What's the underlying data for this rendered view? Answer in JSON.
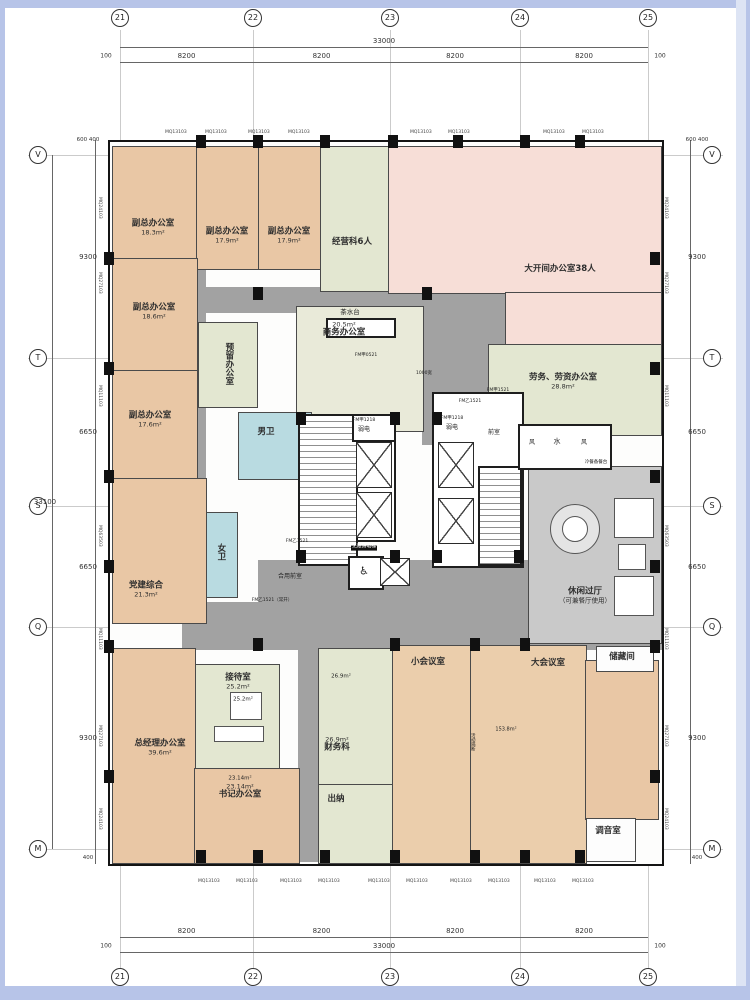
{
  "drawing_type": "office floor plan",
  "colors": {
    "office_tan": "#e9c7a5",
    "open_office_pink": "#f7ded7",
    "green_room": "#e3e7d1",
    "meeting_tan": "#ebceac",
    "toilet_blue": "#b9dbe1",
    "corridor_gray": "#a2a2a2",
    "hall_gray": "#c9c9c9",
    "wall": "#141414",
    "frame_blue": "#b7c4e8",
    "frame_blue_light": "#dde4f4"
  },
  "grid": {
    "cols": [
      {
        "label": "21",
        "x": 120
      },
      {
        "label": "22",
        "x": 253
      },
      {
        "label": "23",
        "x": 390
      },
      {
        "label": "24",
        "x": 520
      },
      {
        "label": "25",
        "x": 648
      }
    ],
    "rows": [
      {
        "label": "V",
        "y": 155
      },
      {
        "label": "T",
        "y": 358
      },
      {
        "label": "S",
        "y": 506
      },
      {
        "label": "Q",
        "y": 627
      },
      {
        "label": "M",
        "y": 849
      }
    ]
  },
  "dims": {
    "top": {
      "total": "33000",
      "segments": [
        "8200",
        "8200",
        "8200",
        "8200"
      ],
      "edge": "100"
    },
    "bottom": {
      "total": "33000",
      "segments": [
        "8200",
        "8200",
        "8200",
        "8200"
      ],
      "edge": "100"
    },
    "left": {
      "total": "33100",
      "segments": [
        "9300",
        "6650",
        "6650",
        "9300"
      ],
      "top_extra": [
        "600",
        "400"
      ],
      "bottom_extra": "400"
    },
    "right": {
      "segments": [
        "9300",
        "6650",
        "6650",
        "9300"
      ],
      "top_extra": [
        "600",
        "400"
      ],
      "bottom_extra": "400"
    }
  },
  "corridors": [
    [
      182,
      255,
      24,
      350
    ],
    [
      182,
      287,
      343,
      26
    ],
    [
      422,
      300,
      108,
      145
    ],
    [
      258,
      560,
      272,
      48
    ],
    [
      182,
      602,
      480,
      48
    ],
    [
      298,
      602,
      20,
      260
    ]
  ],
  "rooms": [
    {
      "label": "副总办公室",
      "area": "18.3m²",
      "x": 112,
      "y": 146,
      "w": 84,
      "h": 112,
      "fill": "#e9c7a5",
      "lx": 153,
      "ly": 228
    },
    {
      "label": "副总办公室",
      "area": "17.9m²",
      "x": 196,
      "y": 146,
      "w": 62,
      "h": 122,
      "fill": "#e9c7a5",
      "lx": 227,
      "ly": 236
    },
    {
      "label": "副总办公室",
      "area": "17.9m²",
      "x": 258,
      "y": 146,
      "w": 62,
      "h": 122,
      "fill": "#e9c7a5",
      "lx": 289,
      "ly": 236
    },
    {
      "label": "经营科6人",
      "x": 320,
      "y": 146,
      "w": 68,
      "h": 144,
      "fill": "#e3e7d1",
      "lx": 352,
      "ly": 243,
      "pat": "pat-desks"
    },
    {
      "label": "大开间办公室38人",
      "x": 388,
      "y": 146,
      "w": 272,
      "h": 146,
      "fill": "#f7ded7",
      "lx": 560,
      "ly": 270,
      "pat": "pat-desks"
    },
    {
      "x": 505,
      "y": 292,
      "w": 155,
      "h": 52,
      "fill": "#f7ded7",
      "pat": "pat-desks"
    },
    {
      "label": "副总办公室",
      "area": "18.6m²",
      "x": 112,
      "y": 258,
      "w": 84,
      "h": 112,
      "fill": "#e9c7a5",
      "lx": 154,
      "ly": 312
    },
    {
      "label": "副总办公室",
      "area": "17.6m²",
      "x": 112,
      "y": 370,
      "w": 84,
      "h": 108,
      "fill": "#e9c7a5",
      "lx": 150,
      "ly": 420
    },
    {
      "label": "预留办公室",
      "x": 198,
      "y": 322,
      "w": 58,
      "h": 84,
      "fill": "#e3e7d1",
      "lx": 228,
      "ly": 364,
      "vert": true,
      "pat": "pat-desks"
    },
    {
      "label": "商务办公室",
      "area": "20.5m²",
      "x": 296,
      "y": 306,
      "w": 126,
      "h": 124,
      "fill": "#e9ead9",
      "lx": 344,
      "ly": 330,
      "areaFirst": true,
      "pat": "pat-desks"
    },
    {
      "label": "劳务、劳资办公室",
      "area": "28.8m²",
      "x": 488,
      "y": 344,
      "w": 172,
      "h": 90,
      "fill": "#e3e7d1",
      "lx": 563,
      "ly": 382
    },
    {
      "label": "党建综合",
      "area": "21.3m²",
      "x": 112,
      "y": 478,
      "w": 93,
      "h": 144,
      "fill": "#e9c7a5",
      "lx": 146,
      "ly": 590
    },
    {
      "label": "休闲过厅",
      "area": "（可兼餐厅使用）",
      "x": 528,
      "y": 466,
      "w": 132,
      "h": 176,
      "fill": "#c9c9c9",
      "lx": 585,
      "ly": 596
    },
    {
      "label": "接待室",
      "area": "25.2m²",
      "x": 194,
      "y": 664,
      "w": 84,
      "h": 104,
      "fill": "#e3e7d1",
      "lx": 238,
      "ly": 682
    },
    {
      "label": "总经理办公室",
      "area": "39.6m²",
      "x": 112,
      "y": 648,
      "w": 82,
      "h": 214,
      "fill": "#e9c7a5",
      "lx": 160,
      "ly": 748
    },
    {
      "label": "书记办公室",
      "area": "23.14m²",
      "x": 194,
      "y": 768,
      "w": 104,
      "h": 94,
      "fill": "#e9c7a5",
      "lx": 240,
      "ly": 792,
      "areaFirst": true
    },
    {
      "label": "财务科",
      "area": "26.9m²",
      "x": 318,
      "y": 648,
      "w": 74,
      "h": 136,
      "fill": "#e3e7d1",
      "lx": 337,
      "ly": 745,
      "areaFirst": true,
      "pat": "pat-desks"
    },
    {
      "label": "出纳",
      "x": 318,
      "y": 784,
      "w": 74,
      "h": 78,
      "fill": "#e3e7d1",
      "lx": 336,
      "ly": 800
    },
    {
      "label": "小会议室",
      "x": 392,
      "y": 645,
      "w": 78,
      "h": 217,
      "fill": "#ebceac",
      "lx": 428,
      "ly": 663,
      "pat": "pat-rows"
    },
    {
      "label": "大会议室",
      "x": 470,
      "y": 645,
      "w": 115,
      "h": 217,
      "fill": "#ebceac",
      "lx": 548,
      "ly": 664,
      "pat": "pat-rows"
    },
    {
      "x": 585,
      "y": 660,
      "w": 72,
      "h": 158,
      "fill": "#e9c7a5",
      "pat": "pat-rows"
    },
    {
      "label": "男卫",
      "x": 238,
      "y": 412,
      "w": 72,
      "h": 66,
      "fill": "#b9dbe1",
      "lx": 266,
      "ly": 433
    },
    {
      "label": "女卫",
      "x": 206,
      "y": 512,
      "w": 30,
      "h": 84,
      "fill": "#b9dbe1",
      "lx": 220,
      "ly": 552,
      "vert": true
    },
    {
      "label": "储藏间",
      "x": 596,
      "y": 646,
      "w": 56,
      "h": 24,
      "fill": "#fdfdfd",
      "lx": 622,
      "ly": 658
    },
    {
      "label": "调音室",
      "x": 586,
      "y": 818,
      "w": 48,
      "h": 42,
      "fill": "#fdfdfd",
      "lx": 608,
      "ly": 832
    }
  ],
  "cores": [
    {
      "x": 298,
      "y": 414,
      "w": 56,
      "h": 148,
      "stair": true
    },
    {
      "x": 352,
      "y": 414,
      "w": 40,
      "h": 24
    },
    {
      "x": 356,
      "y": 440,
      "w": 36,
      "h": 98
    },
    {
      "x": 432,
      "y": 392,
      "w": 88,
      "h": 172
    },
    {
      "x": 478,
      "y": 466,
      "w": 40,
      "h": 96,
      "stair": true
    },
    {
      "x": 518,
      "y": 424,
      "w": 90,
      "h": 42
    },
    {
      "x": 348,
      "y": 556,
      "w": 32,
      "h": 30
    },
    {
      "x": 326,
      "y": 318,
      "w": 66,
      "h": 16
    }
  ],
  "elevators": [
    [
      356,
      442,
      34,
      44
    ],
    [
      356,
      492,
      34,
      44
    ],
    [
      438,
      442,
      34,
      44
    ],
    [
      438,
      498,
      34,
      44
    ],
    [
      380,
      558,
      28,
      26
    ]
  ],
  "wheelchair_icon": {
    "glyph": "♿",
    "x": 364,
    "y": 571
  },
  "round_table": {
    "x": 550,
    "y": 504,
    "d": 48,
    "inner": 24
  },
  "sofas": [
    [
      614,
      498,
      38,
      38
    ],
    [
      618,
      544,
      26,
      24
    ],
    [
      614,
      576,
      38,
      38
    ],
    [
      230,
      692,
      30,
      26
    ],
    [
      214,
      726,
      48,
      14
    ]
  ],
  "columns": [
    [
      196,
      135
    ],
    [
      253,
      135
    ],
    [
      320,
      135
    ],
    [
      388,
      135
    ],
    [
      453,
      135
    ],
    [
      520,
      135
    ],
    [
      575,
      135
    ],
    [
      196,
      850
    ],
    [
      253,
      850
    ],
    [
      320,
      850
    ],
    [
      390,
      850
    ],
    [
      470,
      850
    ],
    [
      520,
      850
    ],
    [
      575,
      850
    ],
    [
      104,
      252
    ],
    [
      104,
      362
    ],
    [
      104,
      470
    ],
    [
      104,
      560
    ],
    [
      104,
      640
    ],
    [
      104,
      770
    ],
    [
      650,
      252
    ],
    [
      650,
      362
    ],
    [
      650,
      470
    ],
    [
      650,
      560
    ],
    [
      650,
      640
    ],
    [
      650,
      770
    ],
    [
      253,
      287
    ],
    [
      422,
      287
    ],
    [
      296,
      412
    ],
    [
      390,
      412
    ],
    [
      432,
      412
    ],
    [
      296,
      550
    ],
    [
      390,
      550
    ],
    [
      432,
      550
    ],
    [
      514,
      550
    ],
    [
      390,
      638
    ],
    [
      470,
      638
    ],
    [
      520,
      638
    ],
    [
      253,
      638
    ]
  ],
  "annotations": [
    {
      "t": "茶水台",
      "x": 350,
      "y": 312,
      "fs": 6.5
    },
    {
      "t": "FM甲1218",
      "x": 364,
      "y": 421,
      "fs": 4.5
    },
    {
      "t": "弱电",
      "x": 364,
      "y": 430,
      "fs": 6
    },
    {
      "t": "FM甲1218",
      "x": 452,
      "y": 419,
      "fs": 4.5
    },
    {
      "t": "弱电",
      "x": 452,
      "y": 428,
      "fs": 6
    },
    {
      "t": "前室",
      "x": 494,
      "y": 433,
      "fs": 6
    },
    {
      "t": "风",
      "x": 532,
      "y": 443,
      "fs": 6
    },
    {
      "t": "水",
      "x": 557,
      "y": 442,
      "fs": 7
    },
    {
      "t": "风",
      "x": 584,
      "y": 443,
      "fs": 6
    },
    {
      "t": "冷餐备餐台",
      "x": 596,
      "y": 463,
      "fs": 4.5
    },
    {
      "t": "1000宽",
      "x": 424,
      "y": 374,
      "fs": 4.5
    },
    {
      "t": "FM甲0521",
      "x": 366,
      "y": 356,
      "fs": 4.5
    },
    {
      "t": "FM乙1521",
      "x": 470,
      "y": 402,
      "fs": 4.5
    },
    {
      "t": "FM甲1521",
      "x": 498,
      "y": 391,
      "fs": 4.5
    },
    {
      "t": "FM乙1521",
      "x": 297,
      "y": 542,
      "fs": 4.5
    },
    {
      "t": "FM乙1521（常开）",
      "x": 272,
      "y": 601,
      "fs": 4.5
    },
    {
      "t": "合用前室",
      "x": 290,
      "y": 577,
      "fs": 6
    },
    {
      "t": "无障碍电梯",
      "x": 364,
      "y": 548,
      "fs": 4.8,
      "chip": true
    },
    {
      "t": "活动隔断",
      "x": 472,
      "y": 742,
      "fs": 4.5,
      "vert": true
    },
    {
      "t": "153.8m²",
      "x": 506,
      "y": 730,
      "fs": 5
    },
    {
      "t": "26.9m²",
      "x": 341,
      "y": 677,
      "fs": 5.5
    },
    {
      "t": "23.14m²",
      "x": 240,
      "y": 779,
      "fs": 5.5
    },
    {
      "t": "25.2m²",
      "x": 243,
      "y": 700,
      "fs": 5.5
    }
  ],
  "wall_codes": {
    "left": [
      [
        "MQ24103",
        197
      ],
      [
        "MQ27103",
        272
      ],
      [
        "MQ11103",
        385
      ],
      [
        "MQ63503",
        525
      ],
      [
        "MQ11103",
        628
      ],
      [
        "MQ27103",
        725
      ],
      [
        "MQ24103",
        808
      ]
    ],
    "right": [
      [
        "MQ24103",
        197
      ],
      [
        "MQ27103",
        272
      ],
      [
        "MQ11103",
        385
      ],
      [
        "MQ63503",
        525
      ],
      [
        "MQ11103",
        628
      ],
      [
        "MQ27103",
        725
      ],
      [
        "MQ24103",
        808
      ]
    ],
    "top": {
      "code": "MQ13103",
      "xs": [
        165,
        205,
        248,
        288,
        410,
        448,
        543,
        582
      ],
      "y": 130
    },
    "bottom": {
      "code": "MQ13103",
      "xs": [
        198,
        236,
        280,
        318,
        368,
        406,
        450,
        488,
        534,
        572
      ],
      "y": 879
    }
  }
}
